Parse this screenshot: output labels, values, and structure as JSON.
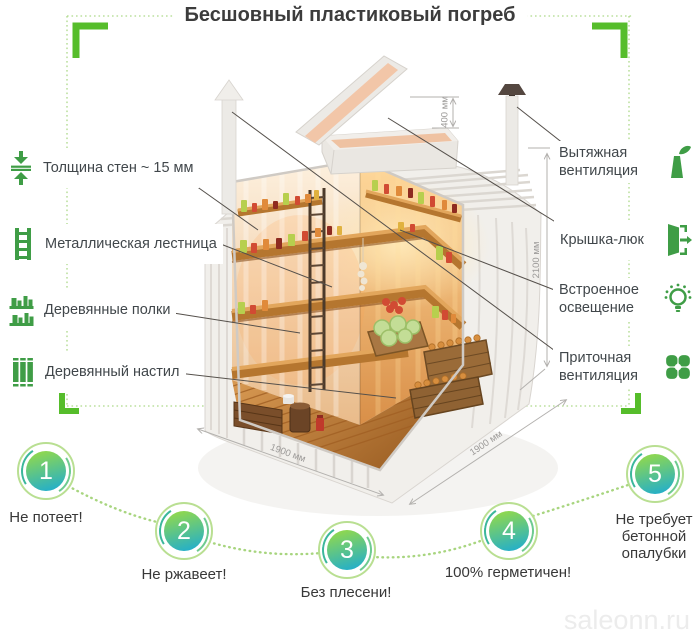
{
  "title": "Бесшовный пластиковый погреб",
  "left_labels": [
    {
      "label": "Толщина стен ~ 15 мм",
      "icon": "wall-thickness-icon"
    },
    {
      "label": "Металлическая лестница",
      "icon": "ladder-icon"
    },
    {
      "label": "Деревянные полки",
      "icon": "wooden-shelves-icon"
    },
    {
      "label": "Деревянный настил",
      "icon": "wooden-deck-icon"
    }
  ],
  "right_labels": [
    {
      "label": "Вытяжная вентиляция",
      "icon": "exhaust-vent-icon"
    },
    {
      "label": "Крышка-люк",
      "icon": "hatch-lid-icon"
    },
    {
      "label": "Встроенное освещение",
      "icon": "built-in-light-icon"
    },
    {
      "label": "Приточная вентиляция",
      "icon": "supply-vent-icon"
    }
  ],
  "dimensions": {
    "neck": "400 мм",
    "height": "2100 мм",
    "width": "1900 мм",
    "depth": "1900 мм"
  },
  "benefits": [
    {
      "number": "1",
      "label": "Не потеет!"
    },
    {
      "number": "2",
      "label": "Не ржавеет!"
    },
    {
      "number": "3",
      "label": "Без плесени!"
    },
    {
      "number": "4",
      "label": "100% герметичен!"
    },
    {
      "number": "5",
      "label": "Не требует бетонной опалубки"
    }
  ],
  "watermark": "saleonn.ru",
  "colors": {
    "accent_green": "#56bd2b",
    "dotted_green": "#aed98a",
    "icon_green": "#3f9d46",
    "badge_ring": "#b9df92",
    "badge_gradient_top": "#90d84e",
    "badge_gradient_bottom": "#27b0c6",
    "dimension_gray": "#9c9a98"
  }
}
